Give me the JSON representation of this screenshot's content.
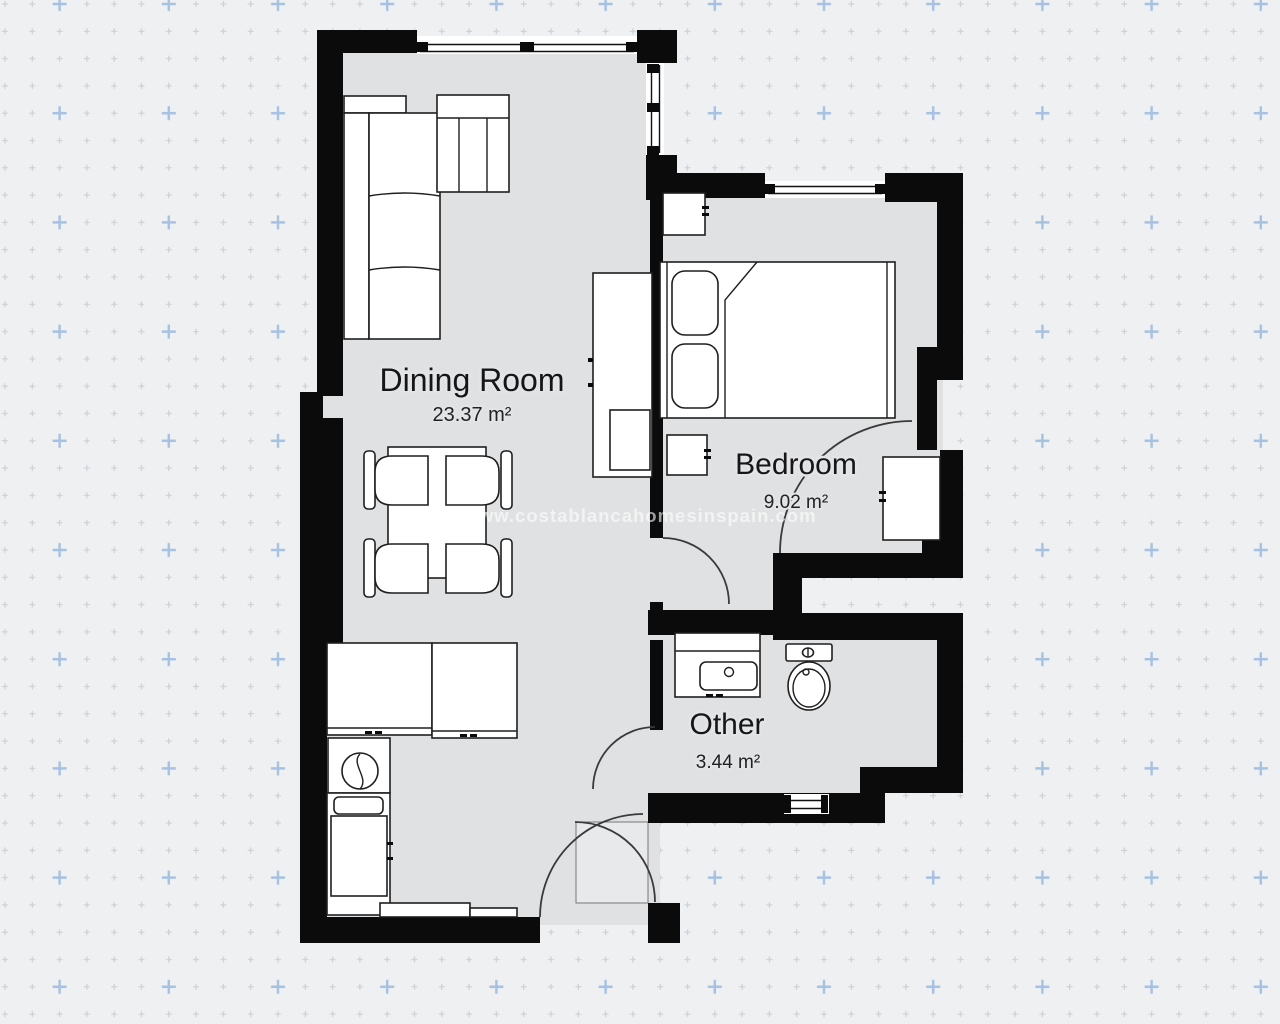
{
  "page": {
    "background": "#eef0f2"
  },
  "watermark": {
    "text": "www.costablancahomesinspain.com"
  },
  "rooms": [
    {
      "name": "Dining Room",
      "area": "23.37 m²"
    },
    {
      "name": "Bedroom",
      "area": "9.02 m²"
    },
    {
      "name": "Other",
      "area": "3.44 m²"
    }
  ],
  "fixtures": [
    "corner-sofa",
    "armchair",
    "dining-table",
    "dining-chair",
    "tv-unit",
    "double-bed",
    "pillow",
    "nightstand",
    "wardrobe",
    "kitchen-cabinet",
    "kitchen-sink",
    "washing-machine",
    "kitchen-counter",
    "bathroom-vanity",
    "toilet",
    "door-swing",
    "window",
    "entrance-door"
  ],
  "colors": {
    "bg": "#eef0f2",
    "floor": "#e0e1e3",
    "floor_light": "#e8e9eb",
    "wall": "#0b0b0b",
    "line": "#1f1f1f",
    "grid_dot": "#c9ced3",
    "grid_blue": "#a6c1e2",
    "watermark": "#ffffff",
    "label": "#161616",
    "halo": "#e3e4e6"
  }
}
